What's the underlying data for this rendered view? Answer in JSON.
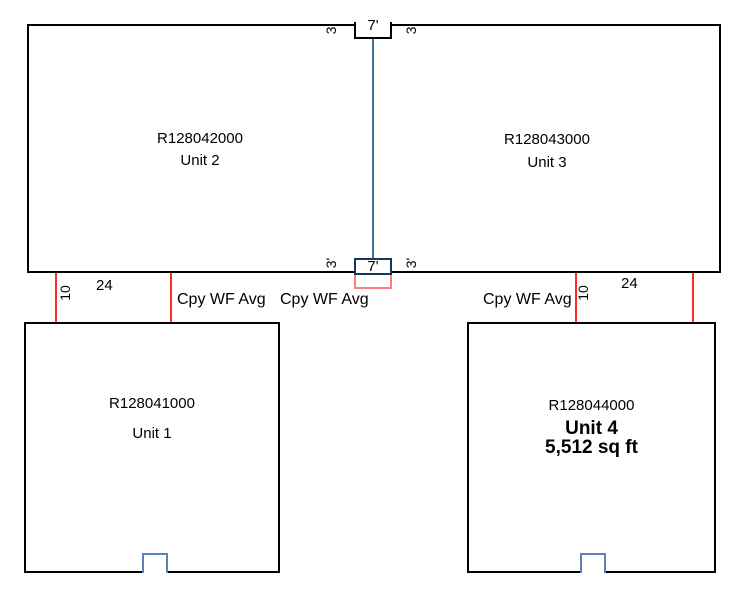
{
  "diagram": {
    "type": "parcel-sketch",
    "units": {
      "unit2": {
        "parcel_id": "R128042000",
        "label": "Unit 2"
      },
      "unit3": {
        "parcel_id": "R128043000",
        "label": "Unit 3"
      },
      "unit1": {
        "parcel_id": "R128041000",
        "label": "Unit 1"
      },
      "unit4": {
        "parcel_id": "R128044000",
        "label": "Unit 4",
        "area": "5,512 sq ft"
      }
    },
    "dimensions": {
      "porch_width": "7'",
      "porch_side_offset": "3'",
      "connector_depth": "10",
      "connector_span": "24",
      "wall_label": "Cpy WF Avg"
    },
    "colors": {
      "wall": "#000000",
      "divider_line": "#3f7296",
      "porch_box_upper": "#17375d",
      "porch_box_lower": "#ff7c80",
      "connector_line": "#ff2b2b",
      "door_marker": "#5b82b8"
    }
  }
}
